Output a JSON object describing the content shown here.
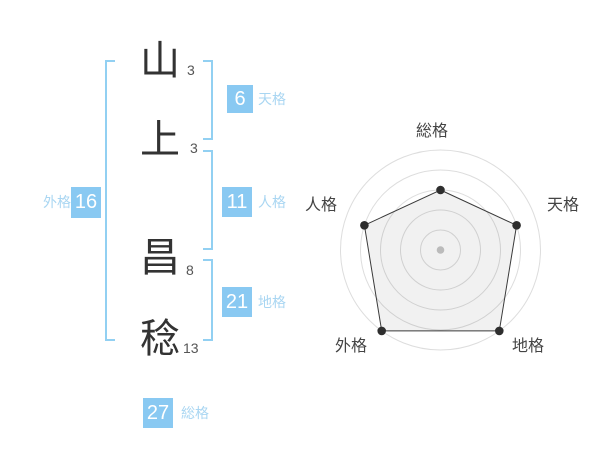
{
  "name": {
    "characters": [
      {
        "char": "山",
        "strokes": "3"
      },
      {
        "char": "上",
        "strokes": "3"
      },
      {
        "char": "昌",
        "strokes": "8"
      },
      {
        "char": "稔",
        "strokes": "13"
      }
    ]
  },
  "kaku": {
    "tenkaku": {
      "label": "天格",
      "value": "6"
    },
    "jinkaku": {
      "label": "人格",
      "value": "11"
    },
    "chikaku": {
      "label": "地格",
      "value": "21"
    },
    "gaikaku": {
      "label": "外格",
      "value": "16"
    },
    "soukaku": {
      "label": "総格",
      "value": "27"
    }
  },
  "colors": {
    "accent_blue": "#89c9f2",
    "label_blue": "#a9d6f2",
    "bracket_blue": "#92d0f2",
    "name_text": "#333333",
    "stroke_text": "#555555",
    "radar_label": "#444444",
    "grid": "#dddddd",
    "polygon_stroke": "#3a3a3a",
    "polygon_fill": "rgba(0,0,0,0.055)",
    "point": "#2e2e2e",
    "center_dot": "#bbbbbb"
  },
  "chart_data": {
    "type": "radar",
    "categories": [
      "総格",
      "天格",
      "地格",
      "外格",
      "人格"
    ],
    "values": [
      3,
      4,
      5,
      5,
      4
    ],
    "max": 5,
    "rings": 5,
    "start_angle_deg": -90,
    "direction": "clockwise",
    "grid": "circular",
    "legend": "none",
    "title": ""
  }
}
